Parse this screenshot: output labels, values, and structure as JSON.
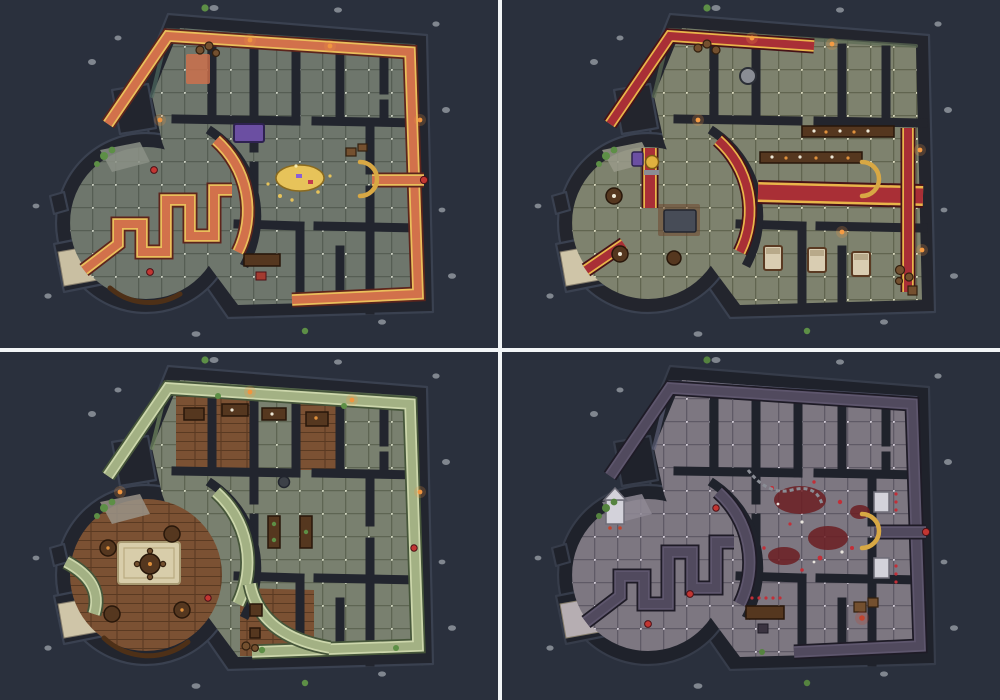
{
  "page": {
    "title": "battle-map-variants-grid",
    "layout": "2x2-grid",
    "colors": {
      "gutter": "#f2f5f7",
      "background": "#2a303d"
    }
  },
  "panels": [
    {
      "name": "map-variant-orange-keep",
      "position": "top-left",
      "features": [
        "circular-tower-room",
        "greek-key-meander-carpet",
        "perimeter-corridor-carpet",
        "treasure-hoard-central-hall",
        "purple-bed",
        "barrel-storage",
        "stone-steps-entrance"
      ],
      "colors": {
        "bg": "#2a303d",
        "wall": "#22252e",
        "wall_edge": "#3a4150",
        "floor": "#6e766c",
        "grout": "#565e54",
        "dot": "#c9cec0",
        "carpet": "#d2714b",
        "carpet_trim": "#eabf5b",
        "carpet_outline": "#5d241c",
        "lining": "#4e6a61",
        "steps": "#c9bfa2",
        "patch": "#8b9086",
        "glow": "#f0953f",
        "bush": "#5d8f46",
        "pebble": "#8f959d",
        "gold": "#e7c35a",
        "blood": "#6b1d22",
        "blood2": "#c22f38"
      }
    },
    {
      "name": "map-variant-red-feast-hall",
      "position": "top-right",
      "features": [
        "circular-tower-room",
        "red-runner-carpets",
        "banquet-tables-with-food",
        "golden-statue",
        "round-stove",
        "guest-beds",
        "barrel-stacks"
      ],
      "colors": {
        "bg": "#2a303d",
        "wall": "#23252d",
        "wall_edge": "#3a4150",
        "floor": "#7e826e",
        "grout": "#616550",
        "dot": "#d6d6bb",
        "carpet": "#a92f36",
        "carpet_trim": "#e9b54a",
        "carpet_outline": "#471217",
        "lining": "#5d6b54",
        "steps": "#cfc5a8",
        "patch": "#999a8a",
        "glow": "#f59b43",
        "bush": "#5d8f46",
        "pebble": "#8f959d",
        "gold": "#e0b13f",
        "blood": "#6b1d22",
        "blood2": "#c22f38"
      }
    },
    {
      "name": "map-variant-green-tavern",
      "position": "bottom-left",
      "features": [
        "circular-tower-room",
        "wooden-plank-floor",
        "round-tavern-tables",
        "cream-rug",
        "green-border-carpets",
        "dining-rooms",
        "plant-pots"
      ],
      "colors": {
        "bg": "#2a303d",
        "wall": "#22252e",
        "wall_edge": "#3a4150",
        "floor": "#79806f",
        "grout": "#5e6553",
        "dot": "#ced3bd",
        "carpet": "#a3b184",
        "carpet_trim": "#ccd6ab",
        "carpet_outline": "#46563a",
        "lining": "#70875f",
        "steps": "#cfc5a8",
        "patch": "#9a9387",
        "glow": "#f0953f",
        "bush": "#5d8f46",
        "pebble": "#8f959d",
        "gold": "#d8a844",
        "wood": "#7b5133",
        "wood_line": "#5a3a22",
        "rug": "#d8cdaa",
        "blood": "#6b1d22",
        "blood2": "#c22f38"
      }
    },
    {
      "name": "map-variant-dark-ruined",
      "position": "bottom-right",
      "features": [
        "circular-tower-room",
        "dark-meander-carpet",
        "blood-stains",
        "scattered-bones",
        "chain",
        "white-statues-alcoves",
        "shrine",
        "ritual-markings"
      ],
      "colors": {
        "bg": "#2a303d",
        "wall": "#1f222b",
        "wall_edge": "#363c4a",
        "floor": "#7d7781",
        "grout": "#5f5a66",
        "dot": "#cfc9d4",
        "carpet": "#514a5e",
        "carpet_trim": "#5e566d",
        "carpet_outline": "#1e1b26",
        "lining": "#5c6077",
        "steps": "#b6aeb2",
        "patch": "#8e8894",
        "glow": "#c2452f",
        "bush": "#55833f",
        "pebble": "#8f959d",
        "gold": "#d8a844",
        "blood": "#6b1d22",
        "blood2": "#c22f38"
      }
    }
  ]
}
